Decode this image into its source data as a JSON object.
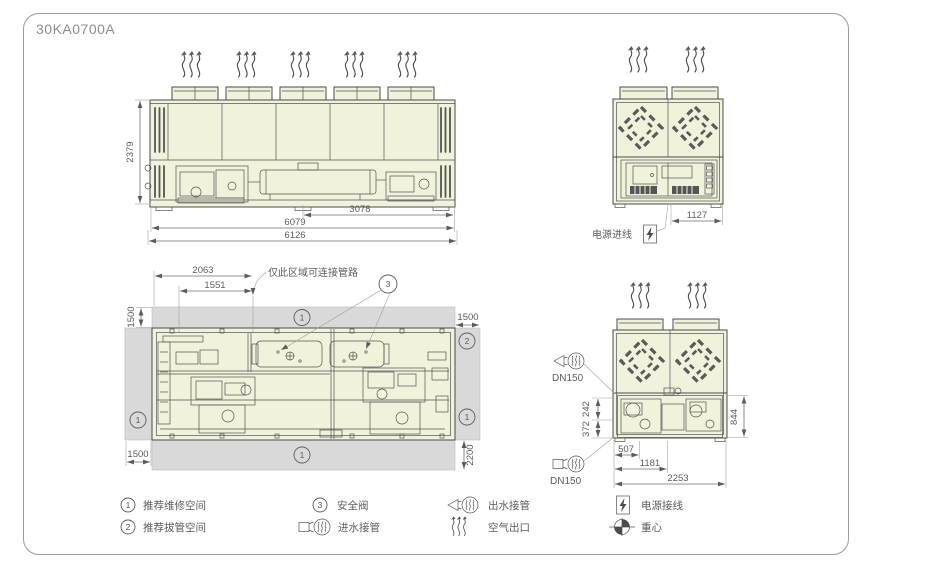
{
  "title": "30KA0700A",
  "side_view": {
    "height": "2379",
    "len_inner": "3078",
    "len_mid": "6079",
    "len_total": "6126"
  },
  "rear_view": {
    "width": "1127",
    "power_inlet_label": "电源进线"
  },
  "plan_view": {
    "pipe_zone_w": "2063",
    "pipe_zone_w2": "1551",
    "note": "仅此区域可连接管路",
    "clr_top": "1500",
    "clr_right": "1500",
    "clr_left": "1500",
    "clr_bottom": "2200",
    "badge1": "1",
    "badge2": "2",
    "badge3": "3"
  },
  "front_view": {
    "dn_top": "DN150",
    "dn_bottom": "DN150",
    "v_242": "242",
    "v_372": "372",
    "v_844": "844",
    "h_507": "507",
    "h_1181": "1181",
    "h_2253": "2253"
  },
  "legend": {
    "n1": "1",
    "t1": "推荐维修空间",
    "n2": "2",
    "t2": "推荐拔管空间",
    "n3": "3",
    "t3": "安全阀",
    "t4": "进水接管",
    "t5": "出水接管",
    "t6": "空气出口",
    "t7": "电源接线",
    "t8": "重心"
  }
}
